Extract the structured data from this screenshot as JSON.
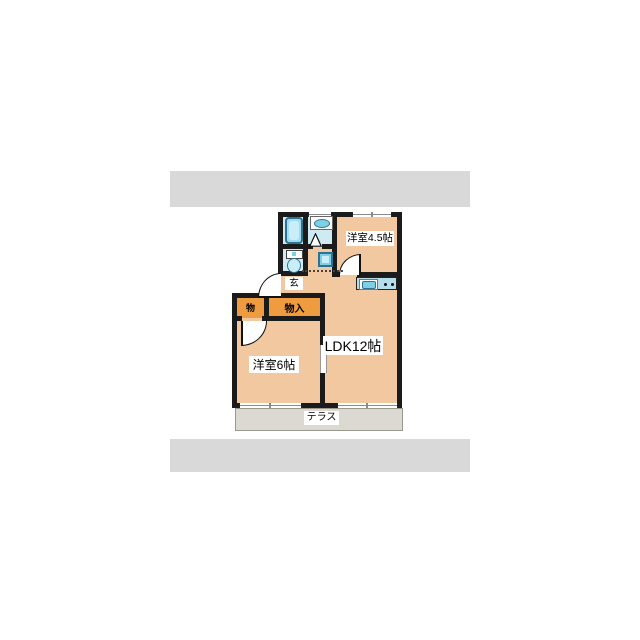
{
  "rooms": {
    "r45": {
      "label": "洋室4.5帖"
    },
    "ldk": {
      "label": "LDK12帖"
    },
    "r6": {
      "label": "洋室6帖"
    },
    "genkan": {
      "label": "玄"
    },
    "closet_small": {
      "label": "物"
    },
    "closet": {
      "label": "物入"
    },
    "terrace": {
      "label": "テラス"
    }
  },
  "fixtures": [
    "bathtub",
    "washbasin-sink",
    "toilet",
    "washing-machine",
    "kitchen-sink",
    "stove-burners",
    "folding-door",
    "entrance-door-arc",
    "room-door-arcs",
    "sliding-door"
  ],
  "colors": {
    "wall": "#1b1b1b",
    "peach": "#f2c8a0",
    "wet": "#cfeaf3",
    "cyan": "#7ed0e6",
    "cyan_light": "#c9eef8",
    "cyan_mid": "#9edcee",
    "border_blue": "#2e7291",
    "orange": "#ef9b40",
    "terrace": "#dcd9d3",
    "band": "#d9d9d9",
    "window_line": "#8a8a8a",
    "counter": "#b5dcea"
  }
}
